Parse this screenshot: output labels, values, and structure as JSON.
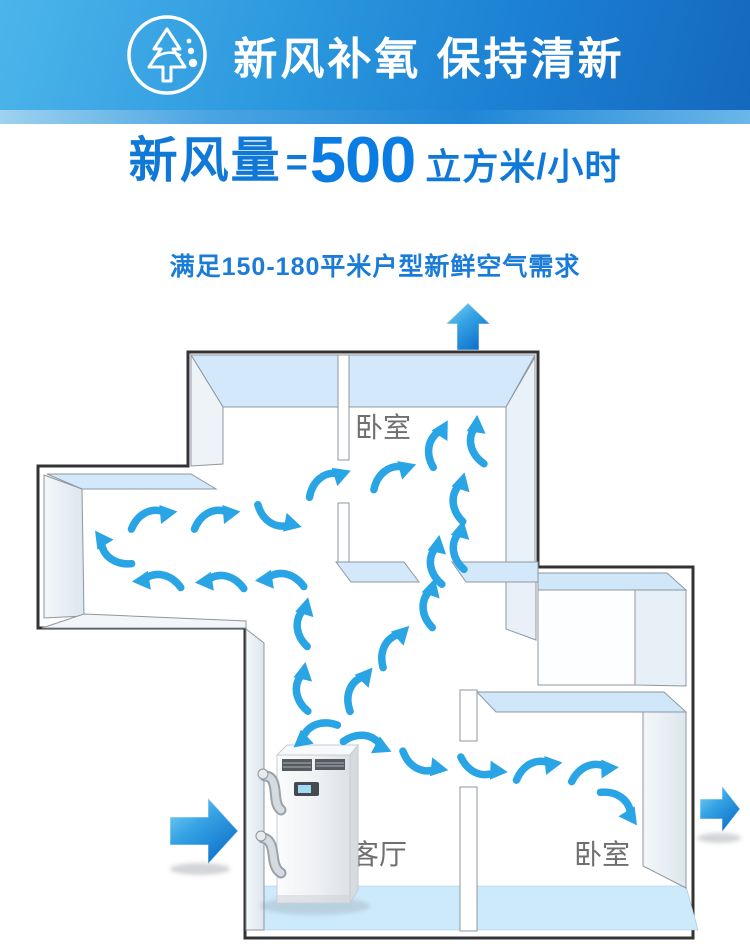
{
  "header": {
    "title": "新风补氧 保持清新",
    "icon": "fresh-air-tree-icon",
    "bg_from": "#4cb5ea",
    "bg_to": "#1568bd"
  },
  "headline": {
    "label": "新风量",
    "equals": "=",
    "value": "500",
    "unit": "立方米/小时",
    "color": "#1079d8"
  },
  "subtitle": {
    "text": "满足150-180平米户型新鲜空气需求"
  },
  "floorplan": {
    "rooms": [
      {
        "name": "bedroom-top",
        "label": "卧室"
      },
      {
        "name": "living-room",
        "label": "客厅"
      },
      {
        "name": "bedroom-right",
        "label": "卧室"
      }
    ],
    "device": {
      "name": "ventilation-unit"
    },
    "colors": {
      "outline": "#333333",
      "wall_top_face": "#d3e9fb",
      "wall_side_face": "#e9f0f7",
      "floor_strip": "#cdeafb",
      "flow_arrow": "#29a4e4",
      "big_arrow_light": "#86d7f4",
      "big_arrow_dark": "#0d6fc9",
      "label_gray": "#6f6f6f"
    },
    "big_arrows": [
      {
        "name": "air-out-top",
        "dir": "up"
      },
      {
        "name": "air-in-left",
        "dir": "right"
      },
      {
        "name": "air-out-right",
        "dir": "right"
      }
    ],
    "flow_arrows": [
      {
        "x": 328,
        "y": 481,
        "r": -20
      },
      {
        "x": 393,
        "y": 474,
        "r": -18
      },
      {
        "x": 437,
        "y": 443,
        "r": -60
      },
      {
        "x": 477,
        "y": 440,
        "r": -85
      },
      {
        "x": 460,
        "y": 497,
        "r": -75
      },
      {
        "x": 460,
        "y": 545,
        "r": -78
      },
      {
        "x": 437,
        "y": 560,
        "r": -80
      },
      {
        "x": 153,
        "y": 517,
        "r": -8
      },
      {
        "x": 216,
        "y": 517,
        "r": -8
      },
      {
        "x": 278,
        "y": 519,
        "r": 14,
        "fy": 1
      },
      {
        "x": 111,
        "y": 550,
        "r": 235
      },
      {
        "x": 157,
        "y": 581,
        "r": -6,
        "mx": 1
      },
      {
        "x": 220,
        "y": 582,
        "r": -6,
        "mx": 1
      },
      {
        "x": 280,
        "y": 580,
        "r": -6,
        "mx": 1
      },
      {
        "x": 304,
        "y": 622,
        "r": -76
      },
      {
        "x": 303,
        "y": 687,
        "r": -80
      },
      {
        "x": 314,
        "y": 733,
        "r": -40,
        "mx": 1
      },
      {
        "x": 368,
        "y": 743,
        "r": 25
      },
      {
        "x": 358,
        "y": 688,
        "r": -50
      },
      {
        "x": 393,
        "y": 645,
        "r": -45
      },
      {
        "x": 430,
        "y": 603,
        "r": -74
      },
      {
        "x": 424,
        "y": 764,
        "r": 10,
        "fy": 1
      },
      {
        "x": 483,
        "y": 768,
        "r": 5,
        "fy": 1
      },
      {
        "x": 538,
        "y": 768,
        "r": -8
      },
      {
        "x": 594,
        "y": 771,
        "r": -4
      },
      {
        "x": 621,
        "y": 806,
        "r": 55
      }
    ]
  }
}
